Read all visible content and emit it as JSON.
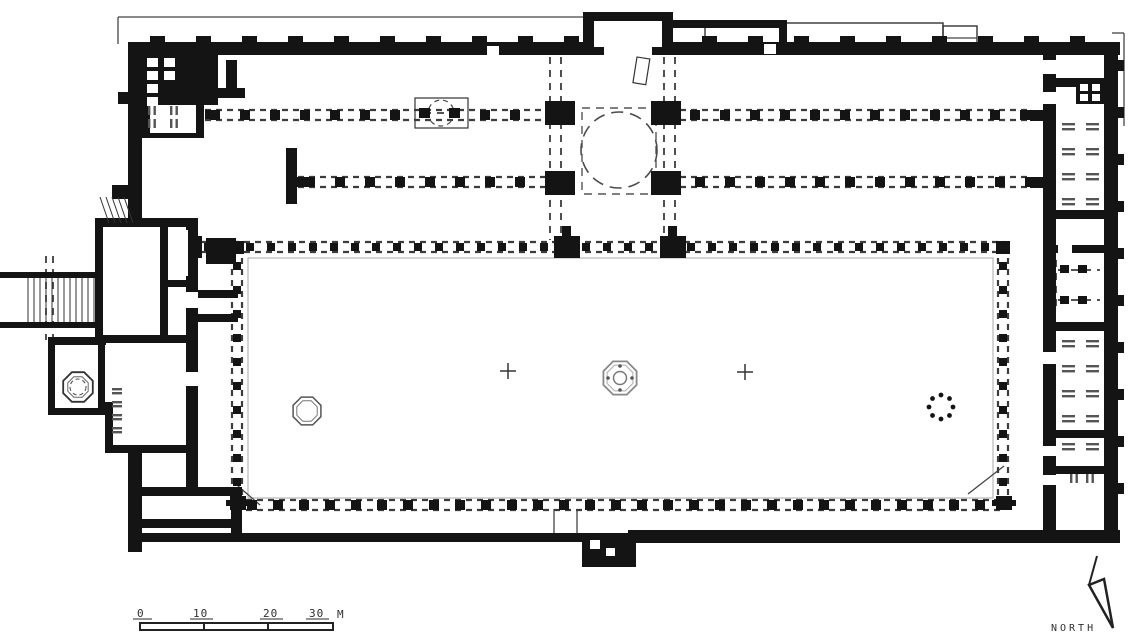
{
  "figure": {
    "kind": "architectural-floor-plan",
    "subject": "hypostyle mosque plan with courtyard"
  },
  "scale_bar": {
    "label0": "0",
    "label10": "10",
    "label20": "20",
    "label30": "30",
    "unit": "M"
  },
  "compass": {
    "label": "NORTH"
  },
  "colors": {
    "ink": "#141414",
    "dash": "#3c3c3c",
    "mid": "#555555",
    "light": "#8a8a8a",
    "bg": "#ffffff"
  },
  "plan": {
    "thin_lines": [
      [
        118,
        17,
        583,
        17
      ],
      [
        118,
        17,
        118,
        44
      ],
      [
        1124,
        33,
        1124,
        126
      ],
      [
        1112,
        33,
        1124,
        33
      ],
      [
        238,
        486,
        260,
        505
      ],
      [
        968,
        494,
        1004,
        466
      ],
      [
        554,
        509,
        554,
        533
      ],
      [
        577,
        509,
        577,
        533
      ],
      [
        943,
        38,
        977,
        38
      ]
    ],
    "outline_rects": [
      {
        "r": [
          705,
          23,
          238,
          25
        ],
        "sw": 1.4
      },
      {
        "r": [
          943,
          26,
          34,
          24
        ],
        "sw": 1.4
      },
      {
        "r": [
          415,
          98,
          53,
          30
        ],
        "sw": 1.2,
        "fill": "#ffffff"
      },
      {
        "r": [
          248,
          258,
          745,
          240
        ],
        "sw": 1,
        "stroke": "#aaaaaa"
      }
    ],
    "colonnades": [
      {
        "t": "h",
        "c": 115,
        "a": 205,
        "b": 1030,
        "s": 30,
        "o": 10,
        "q": 10,
        "skip": [
          [
            546,
            680
          ]
        ],
        "sqskip": [
          [
            405,
            474
          ],
          [
            536,
            690
          ]
        ]
      },
      {
        "t": "h",
        "c": 182,
        "a": 298,
        "b": 1030,
        "s": 30,
        "o": 12,
        "q": 10,
        "skip": [
          [
            546,
            680
          ]
        ],
        "sqskip": [
          [
            536,
            690
          ]
        ]
      },
      {
        "t": "h",
        "c": 247,
        "a": 200,
        "b": 1004,
        "s": 21,
        "o": 8,
        "q": 8,
        "skip": [],
        "sqskip": [
          [
            544,
            584
          ],
          [
            650,
            690
          ]
        ]
      },
      {
        "t": "h",
        "c": 505,
        "a": 246,
        "b": 1000,
        "s": 26,
        "o": 6,
        "q": 10,
        "skip": [],
        "sqskip": []
      },
      {
        "t": "v",
        "c": 237,
        "a": 258,
        "b": 498,
        "s": 24,
        "o": 8,
        "q": 8,
        "skip": [],
        "sqskip": []
      },
      {
        "t": "v",
        "c": 1003,
        "a": 258,
        "b": 498,
        "s": 24,
        "o": 8,
        "q": 8,
        "skip": [],
        "sqskip": []
      }
    ],
    "extra_dashes": [
      [
        550,
        57,
        550,
        240
      ],
      [
        561,
        57,
        561,
        240
      ],
      [
        664,
        57,
        664,
        240
      ],
      [
        675,
        57,
        675,
        240
      ],
      [
        1058,
        270,
        1100,
        270
      ],
      [
        1058,
        300,
        1100,
        300
      ],
      [
        1056,
        260,
        1056,
        310
      ],
      [
        424,
        113,
        456,
        113
      ],
      [
        46,
        256,
        46,
        340
      ],
      [
        53,
        256,
        53,
        340
      ]
    ],
    "dashed_rects": [
      [
        582,
        108,
        74,
        86
      ]
    ],
    "dashed_circles": [
      {
        "c": [
          619,
          150
        ],
        "r": 38,
        "da": "12 7",
        "sw": 1.6,
        "col": "#4a4a4a"
      },
      {
        "c": [
          441,
          113
        ],
        "r": 13,
        "da": "5 4",
        "sw": 1.2,
        "col": "#4a4a4a"
      },
      {
        "c": [
          78,
          387
        ],
        "r": 8,
        "da": "4 3",
        "sw": 1.1,
        "col": "#555555"
      }
    ],
    "ink": [
      [
        128,
        42,
        992,
        13
      ],
      [
        128,
        42,
        14,
        182
      ],
      [
        128,
        452,
        14,
        100
      ],
      [
        128,
        533,
        462,
        9
      ],
      [
        628,
        530,
        492,
        13
      ],
      [
        582,
        533,
        54,
        34
      ],
      [
        1104,
        42,
        14,
        500
      ],
      [
        1043,
        42,
        13,
        500
      ],
      [
        142,
        55,
        76,
        50
      ],
      [
        226,
        60,
        11,
        36
      ],
      [
        217,
        88,
        28,
        10
      ],
      [
        142,
        100,
        8,
        38
      ],
      [
        196,
        100,
        8,
        38
      ],
      [
        142,
        133,
        62,
        5
      ],
      [
        286,
        148,
        11,
        56
      ],
      [
        583,
        12,
        90,
        43
      ],
      [
        661,
        20,
        126,
        8
      ],
      [
        779,
        20,
        8,
        26
      ],
      [
        95,
        218,
        100,
        9
      ],
      [
        95,
        218,
        8,
        124
      ],
      [
        160,
        218,
        8,
        124
      ],
      [
        186,
        218,
        12,
        272
      ],
      [
        160,
        280,
        34,
        7
      ],
      [
        95,
        335,
        99,
        8
      ],
      [
        48,
        337,
        58,
        8
      ],
      [
        48,
        337,
        7,
        78
      ],
      [
        48,
        408,
        58,
        7
      ],
      [
        98,
        345,
        7,
        70
      ],
      [
        105,
        402,
        8,
        50
      ],
      [
        105,
        445,
        85,
        8
      ],
      [
        198,
        290,
        40,
        8
      ],
      [
        198,
        314,
        40,
        8
      ],
      [
        206,
        238,
        30,
        26
      ],
      [
        0,
        272,
        100,
        6
      ],
      [
        0,
        322,
        100,
        6
      ],
      [
        128,
        487,
        114,
        9
      ],
      [
        128,
        519,
        114,
        9
      ],
      [
        231,
        487,
        11,
        55
      ],
      [
        1056,
        78,
        50,
        9
      ],
      [
        1076,
        80,
        30,
        24
      ],
      [
        1045,
        210,
        72,
        9
      ],
      [
        1045,
        245,
        72,
        8
      ],
      [
        1045,
        322,
        72,
        9
      ],
      [
        1045,
        430,
        72,
        8
      ],
      [
        1045,
        466,
        72,
        8
      ],
      [
        1030,
        110,
        14,
        11
      ],
      [
        1030,
        177,
        14,
        11
      ],
      [
        545,
        101,
        30,
        24
      ],
      [
        651,
        101,
        30,
        24
      ],
      [
        545,
        171,
        30,
        24
      ],
      [
        651,
        171,
        30,
        24
      ],
      [
        176,
        236,
        26,
        22
      ],
      [
        554,
        236,
        26,
        22
      ],
      [
        660,
        236,
        26,
        22
      ],
      [
        562,
        226,
        9,
        10
      ],
      [
        668,
        226,
        9,
        10
      ],
      [
        230,
        241,
        14,
        13
      ],
      [
        996,
        241,
        14,
        13
      ],
      [
        230,
        496,
        16,
        14
      ],
      [
        226,
        500,
        24,
        6
      ],
      [
        996,
        496,
        16,
        14
      ],
      [
        992,
        500,
        24,
        6
      ],
      [
        188,
        264,
        9,
        9
      ],
      [
        188,
        312,
        9,
        9
      ],
      [
        188,
        360,
        9,
        9
      ],
      [
        188,
        408,
        9,
        9
      ],
      [
        188,
        456,
        9,
        9
      ],
      [
        419,
        108,
        11,
        10
      ],
      [
        449,
        108,
        11,
        10
      ],
      [
        1060,
        265,
        9,
        8
      ],
      [
        1078,
        265,
        9,
        8
      ],
      [
        1060,
        296,
        9,
        8
      ],
      [
        1078,
        296,
        9,
        8
      ],
      [
        118,
        92,
        10,
        12
      ],
      [
        112,
        185,
        16,
        14
      ],
      [
        296,
        177,
        11,
        10
      ],
      [
        205,
        110,
        10,
        9
      ]
    ],
    "merlons": {
      "y": 36,
      "w": 15,
      "h": 6,
      "x0": 150,
      "x1": 1090,
      "step": 46,
      "skip": [
        578,
        678
      ]
    },
    "right_bumps": {
      "x": 1118,
      "w": 6,
      "h": 11,
      "y0": 60,
      "y1": 515,
      "step": 47
    },
    "white": [
      [
        594,
        21,
        68,
        26
      ],
      [
        604,
        42,
        48,
        13
      ],
      [
        590,
        540,
        10,
        9
      ],
      [
        606,
        548,
        9,
        8
      ],
      [
        147,
        58,
        11,
        9
      ],
      [
        147,
        71,
        11,
        9
      ],
      [
        147,
        84,
        11,
        9
      ],
      [
        147,
        97,
        11,
        9
      ],
      [
        164,
        58,
        11,
        9
      ],
      [
        164,
        71,
        11,
        9
      ],
      [
        1080,
        84,
        8,
        7
      ],
      [
        1092,
        84,
        8,
        7
      ],
      [
        1080,
        94,
        8,
        7
      ],
      [
        1092,
        94,
        8,
        7
      ],
      [
        1043,
        60,
        13,
        14
      ],
      [
        1043,
        92,
        13,
        12
      ],
      [
        1043,
        352,
        13,
        12
      ],
      [
        1043,
        446,
        13,
        10
      ],
      [
        1043,
        475,
        13,
        10
      ],
      [
        1058,
        245,
        14,
        8
      ],
      [
        186,
        292,
        12,
        16
      ],
      [
        186,
        372,
        12,
        14
      ],
      [
        487,
        46,
        12,
        9
      ],
      [
        764,
        44,
        12,
        10
      ],
      [
        168,
        230,
        20,
        46
      ]
    ],
    "stairs": [
      {
        "x0": 28,
        "x1": 95,
        "step": 6,
        "y0": 278,
        "y1": 322
      },
      {
        "diag": true,
        "x0": 100,
        "n": 5,
        "dx": 6,
        "y0": 197,
        "y1": 223,
        "slant": 9
      }
    ],
    "hatches": [
      {
        "type": "h",
        "x": 1062,
        "y": 123,
        "cols": 2,
        "rows": 4,
        "dx": 24,
        "dy": 25
      },
      {
        "type": "h",
        "x": 1062,
        "y": 340,
        "cols": 2,
        "rows": 4,
        "dx": 24,
        "dy": 25
      },
      {
        "type": "h",
        "x": 1062,
        "y": 443,
        "cols": 2,
        "rows": 1,
        "dx": 24,
        "dy": 25
      },
      {
        "type": "h",
        "x": 112,
        "y": 388,
        "cols": 1,
        "rows": 4,
        "dx": 16,
        "dy": 13,
        "small": true
      },
      {
        "type": "v",
        "x": 1070,
        "y": 474,
        "cols": 2,
        "rows": 1,
        "dx": 16,
        "dy": 0
      },
      {
        "type": "v",
        "x": 148,
        "y": 106,
        "cols": 2,
        "rows": 2,
        "dx": 22,
        "dy": 13
      }
    ],
    "octagons": [
      {
        "c": [
          620,
          378
        ],
        "r": 18,
        "sw": 1.8,
        "col": "#888888"
      },
      {
        "c": [
          620,
          378
        ],
        "r": 14,
        "sw": 1,
        "col": "#aaaaaa"
      },
      {
        "c": [
          307,
          411
        ],
        "r": 15,
        "sw": 1.5,
        "col": "#555555"
      },
      {
        "c": [
          307,
          411
        ],
        "r": 11,
        "sw": 1,
        "col": "#777777"
      },
      {
        "c": [
          78,
          387
        ],
        "r": 16,
        "sw": 1.8,
        "col": "#333333"
      },
      {
        "c": [
          78,
          387
        ],
        "r": 11,
        "sw": 1,
        "col": "#666666"
      }
    ],
    "circles": [
      {
        "c": [
          620,
          378
        ],
        "r": 6.5,
        "sw": 1.5,
        "col": "#777777"
      }
    ],
    "dot_ring": {
      "c": [
        941,
        407
      ],
      "R": 12,
      "n": 8,
      "r": 2.4
    },
    "small_dots": [
      [
        620,
        366
      ],
      [
        620,
        390
      ],
      [
        608,
        378
      ],
      [
        632,
        378
      ]
    ],
    "crosses": [
      [
        508,
        371
      ],
      [
        745,
        372
      ]
    ],
    "minbar": {
      "r": [
        637,
        57,
        13,
        26
      ],
      "rot": 9
    }
  }
}
